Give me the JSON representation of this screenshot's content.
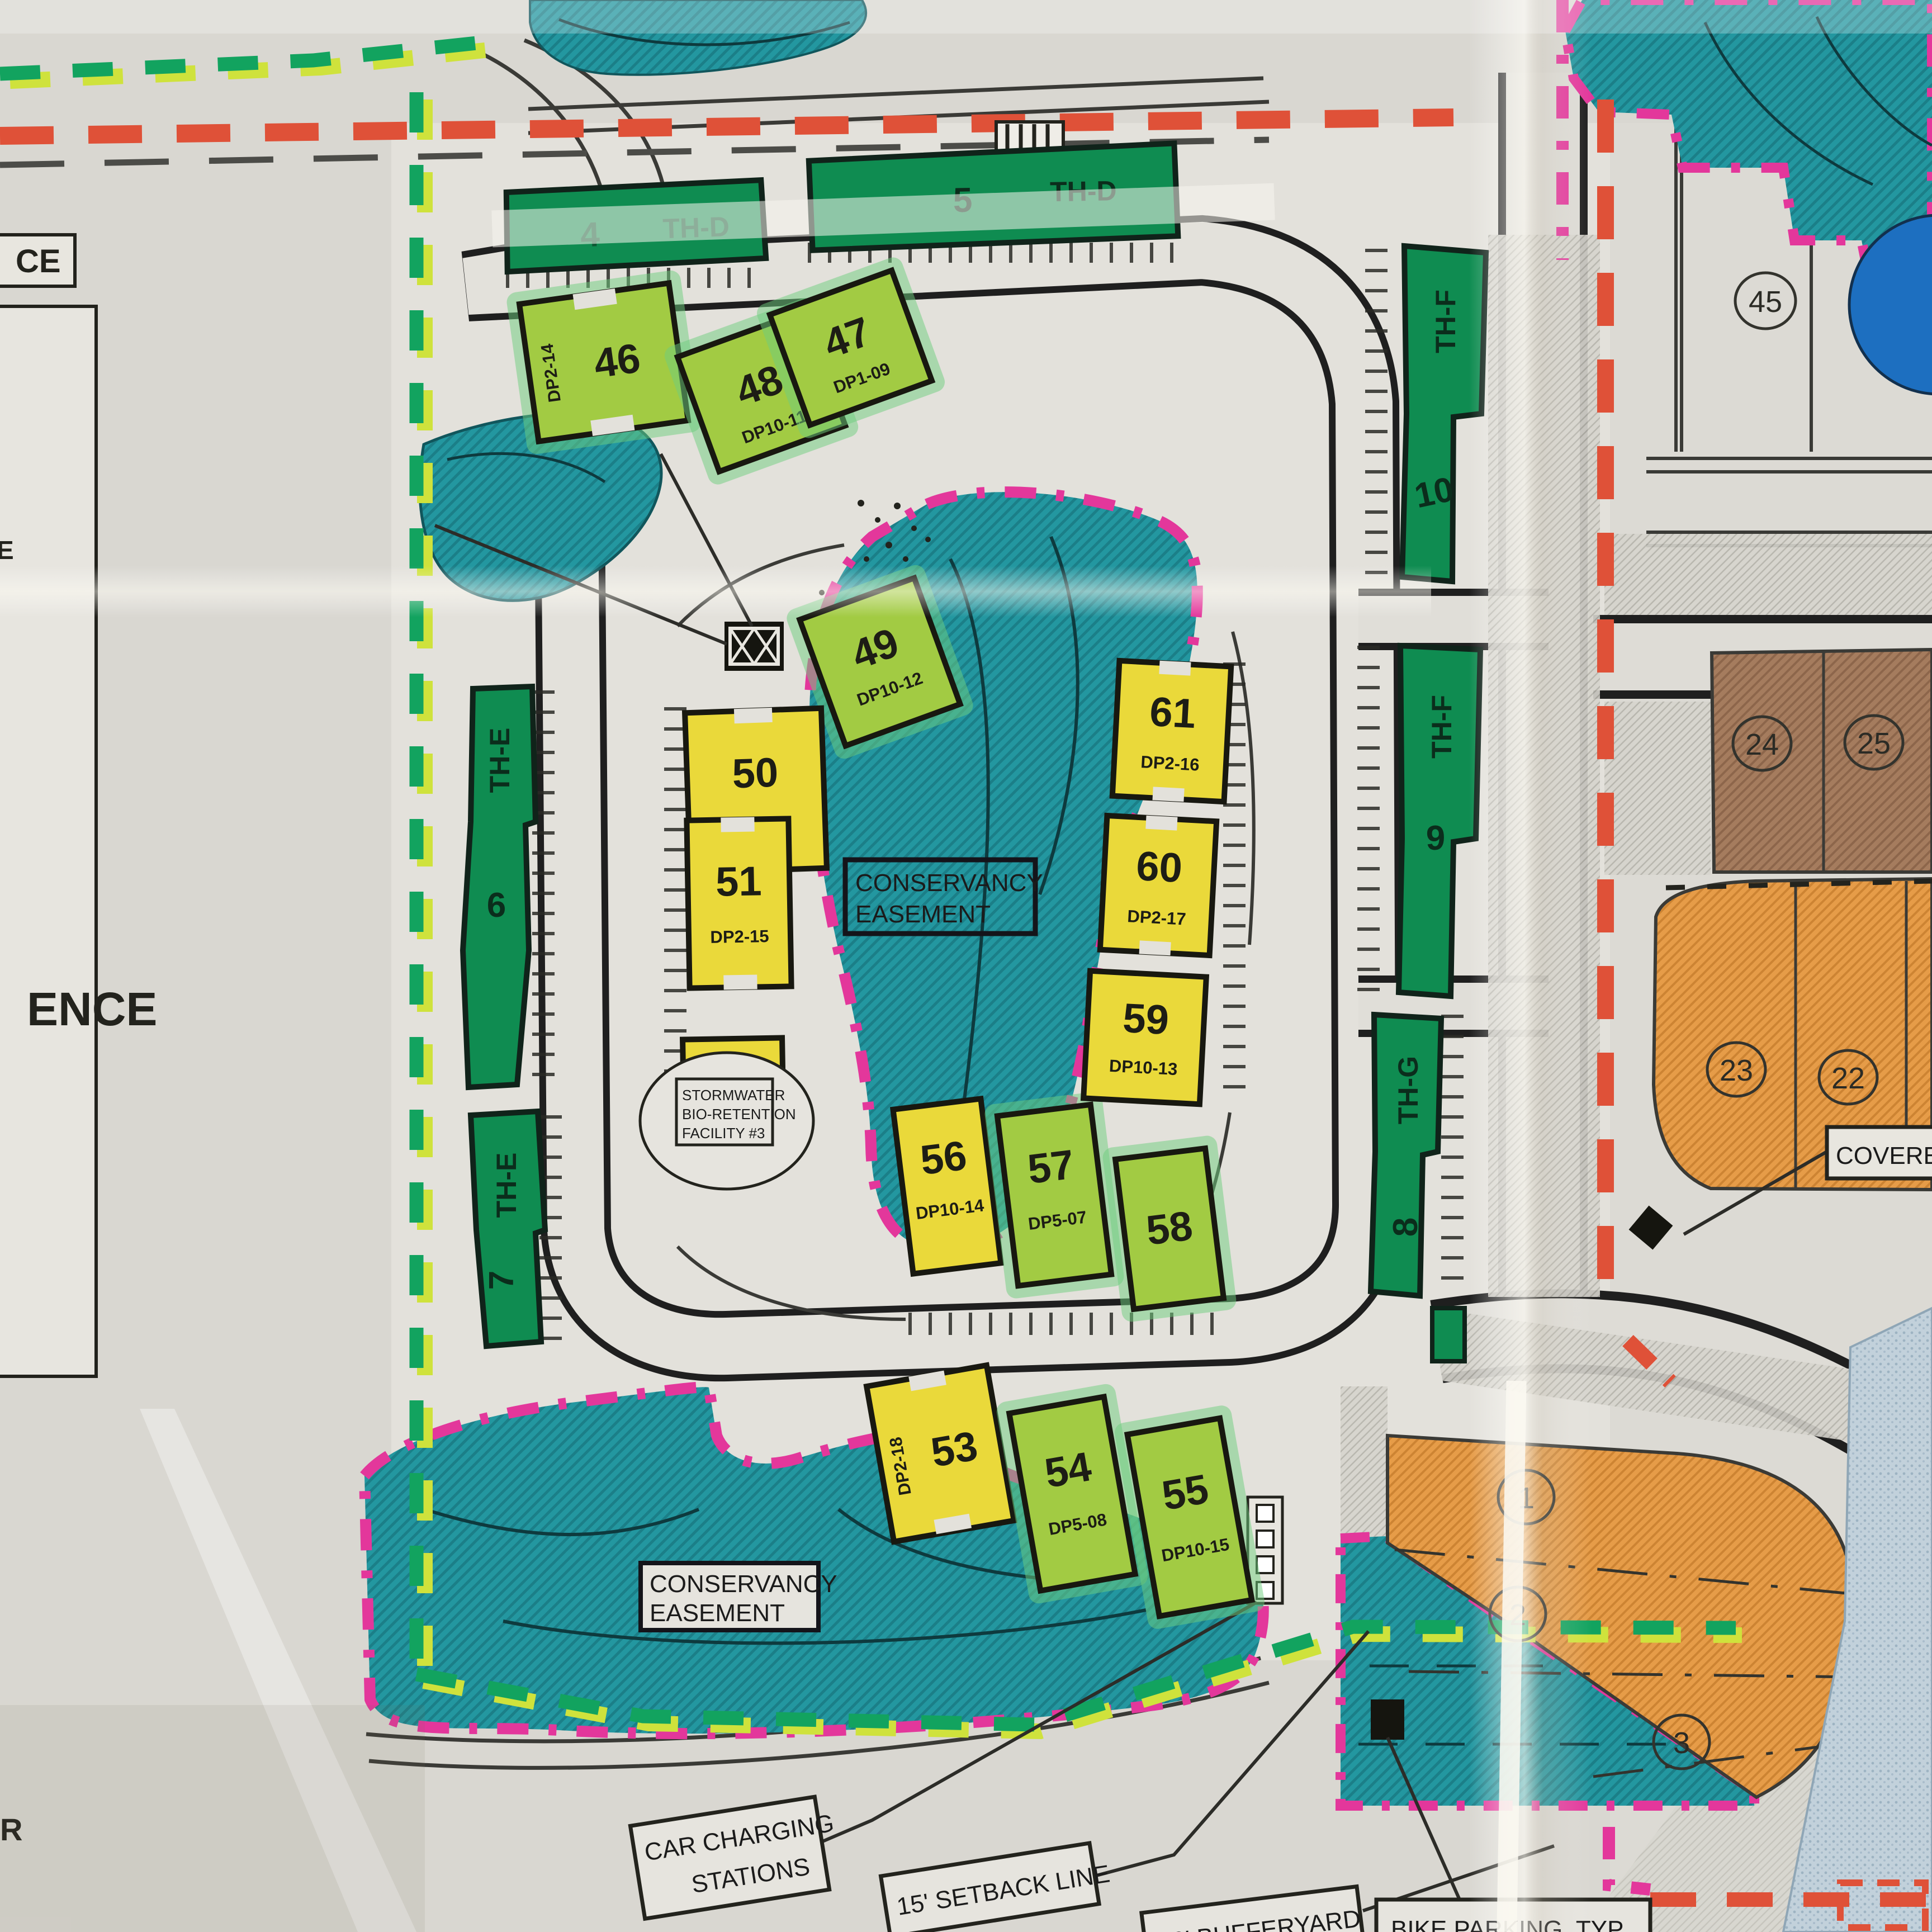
{
  "map": {
    "townhouses": [
      {
        "num": "4",
        "code": "TH-D"
      },
      {
        "num": "5",
        "code": "TH-D"
      },
      {
        "num": "6",
        "code": "TH-E"
      },
      {
        "num": "7",
        "code": "TH-E"
      },
      {
        "num": "8",
        "code": "TH-G"
      },
      {
        "num": "9",
        "code": "TH-F"
      },
      {
        "num": "10",
        "code": "TH-F"
      }
    ],
    "buildings": [
      {
        "num": "46",
        "dp": "DP2-14",
        "highlight": "green"
      },
      {
        "num": "47",
        "dp": "DP1-09",
        "highlight": "green"
      },
      {
        "num": "48",
        "dp": "DP10-11",
        "highlight": "green"
      },
      {
        "num": "49",
        "dp": "DP10-12",
        "highlight": "green"
      },
      {
        "num": "50",
        "dp": "DP5-06",
        "highlight": "yellow"
      },
      {
        "num": "51",
        "dp": "DP2-15",
        "highlight": "yellow"
      },
      {
        "num": "52",
        "dp": "DP1-10",
        "highlight": "yellow"
      },
      {
        "num": "53",
        "dp": "DP2-18",
        "highlight": "yellow"
      },
      {
        "num": "54",
        "dp": "DP5-08",
        "highlight": "green"
      },
      {
        "num": "55",
        "dp": "DP10-15",
        "highlight": "green"
      },
      {
        "num": "56",
        "dp": "DP10-14",
        "highlight": "yellow"
      },
      {
        "num": "57",
        "dp": "DP5-07",
        "highlight": "green"
      },
      {
        "num": "58",
        "dp": "",
        "highlight": "green"
      },
      {
        "num": "59",
        "dp": "DP10-13",
        "highlight": "yellow"
      },
      {
        "num": "60",
        "dp": "DP2-17",
        "highlight": "yellow"
      },
      {
        "num": "61",
        "dp": "DP2-16",
        "highlight": "yellow"
      }
    ],
    "lots": [
      "45",
      "24",
      "25",
      "23",
      "22",
      "1",
      "2",
      "3"
    ],
    "labels": {
      "conservancy_upper": {
        "line1": "CONSERVANCY",
        "line2": "EASEMENT"
      },
      "conservancy_lower": {
        "line1": "CONSERVANCY",
        "line2": "EASEMENT"
      },
      "stormwater": {
        "line1": "STORMWATER",
        "line2": "BIO-RETENTION",
        "line3": "FACILITY #3"
      },
      "car_charging": {
        "line1": "CAR CHARGING",
        "line2": "STATIONS"
      },
      "setback": "15' SETBACK LINE",
      "bufferyard": "10' BUFFERYARD",
      "bike_parking": "BIKE PARKING, TYP",
      "covered": "COVERED",
      "edge_fragments": {
        "top": "CE",
        "mid": "E",
        "reference": "ENCE",
        "bottom": "R"
      }
    },
    "colors": {
      "teal_easement": "#2397a0",
      "building_yellow": "#ead93a",
      "building_green": "#a2cb43",
      "townhouse_green": "#0f8c51",
      "boundary_red": "#df5138",
      "boundary_green": "#12a35f",
      "easement_pink": "#e3379b",
      "lot_orange": "#e69c48",
      "lot_brown": "#a57c5e",
      "pool_blue": "#1d6fc0"
    }
  }
}
